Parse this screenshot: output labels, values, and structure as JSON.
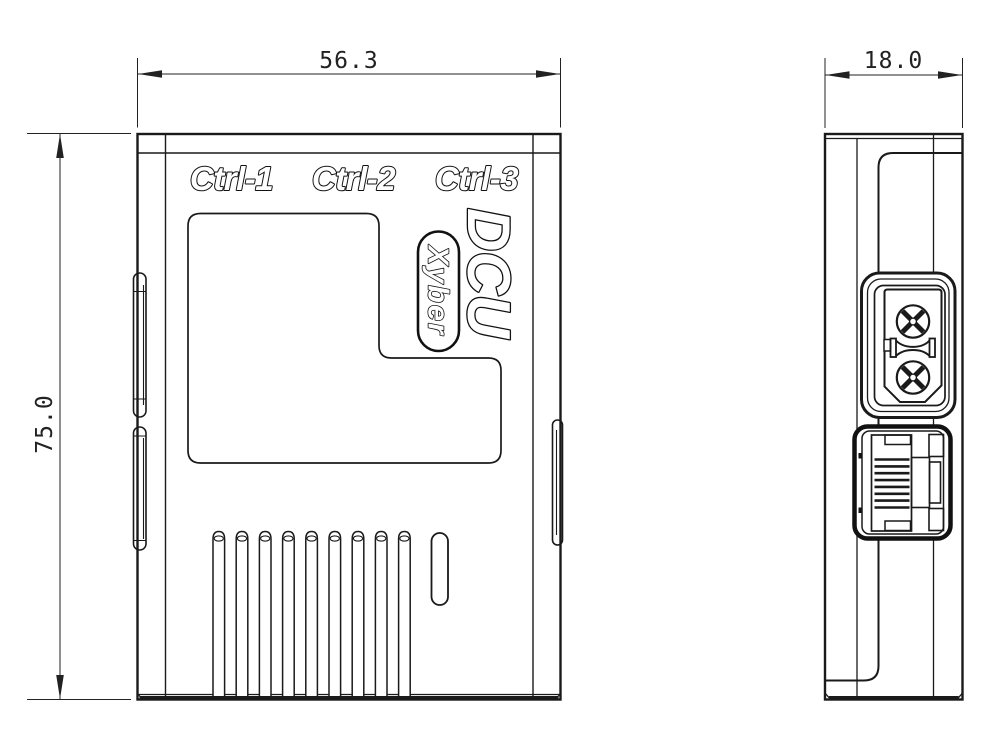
{
  "drawing": {
    "type": "technical-drawing",
    "views": {
      "front": "front view",
      "side": "side view"
    },
    "front_view": {
      "port_labels": [
        "Ctrl-1",
        "Ctrl-2",
        "Ctrl-3"
      ],
      "product_name": "DCU",
      "brand_badge": "Xyber"
    },
    "dimensions_mm": {
      "width": "56.3",
      "height": "75.0",
      "depth": "18.0"
    },
    "colors": {
      "line": "#1a1a1a",
      "dimension_line": "#222222",
      "background": "#ffffff"
    }
  }
}
